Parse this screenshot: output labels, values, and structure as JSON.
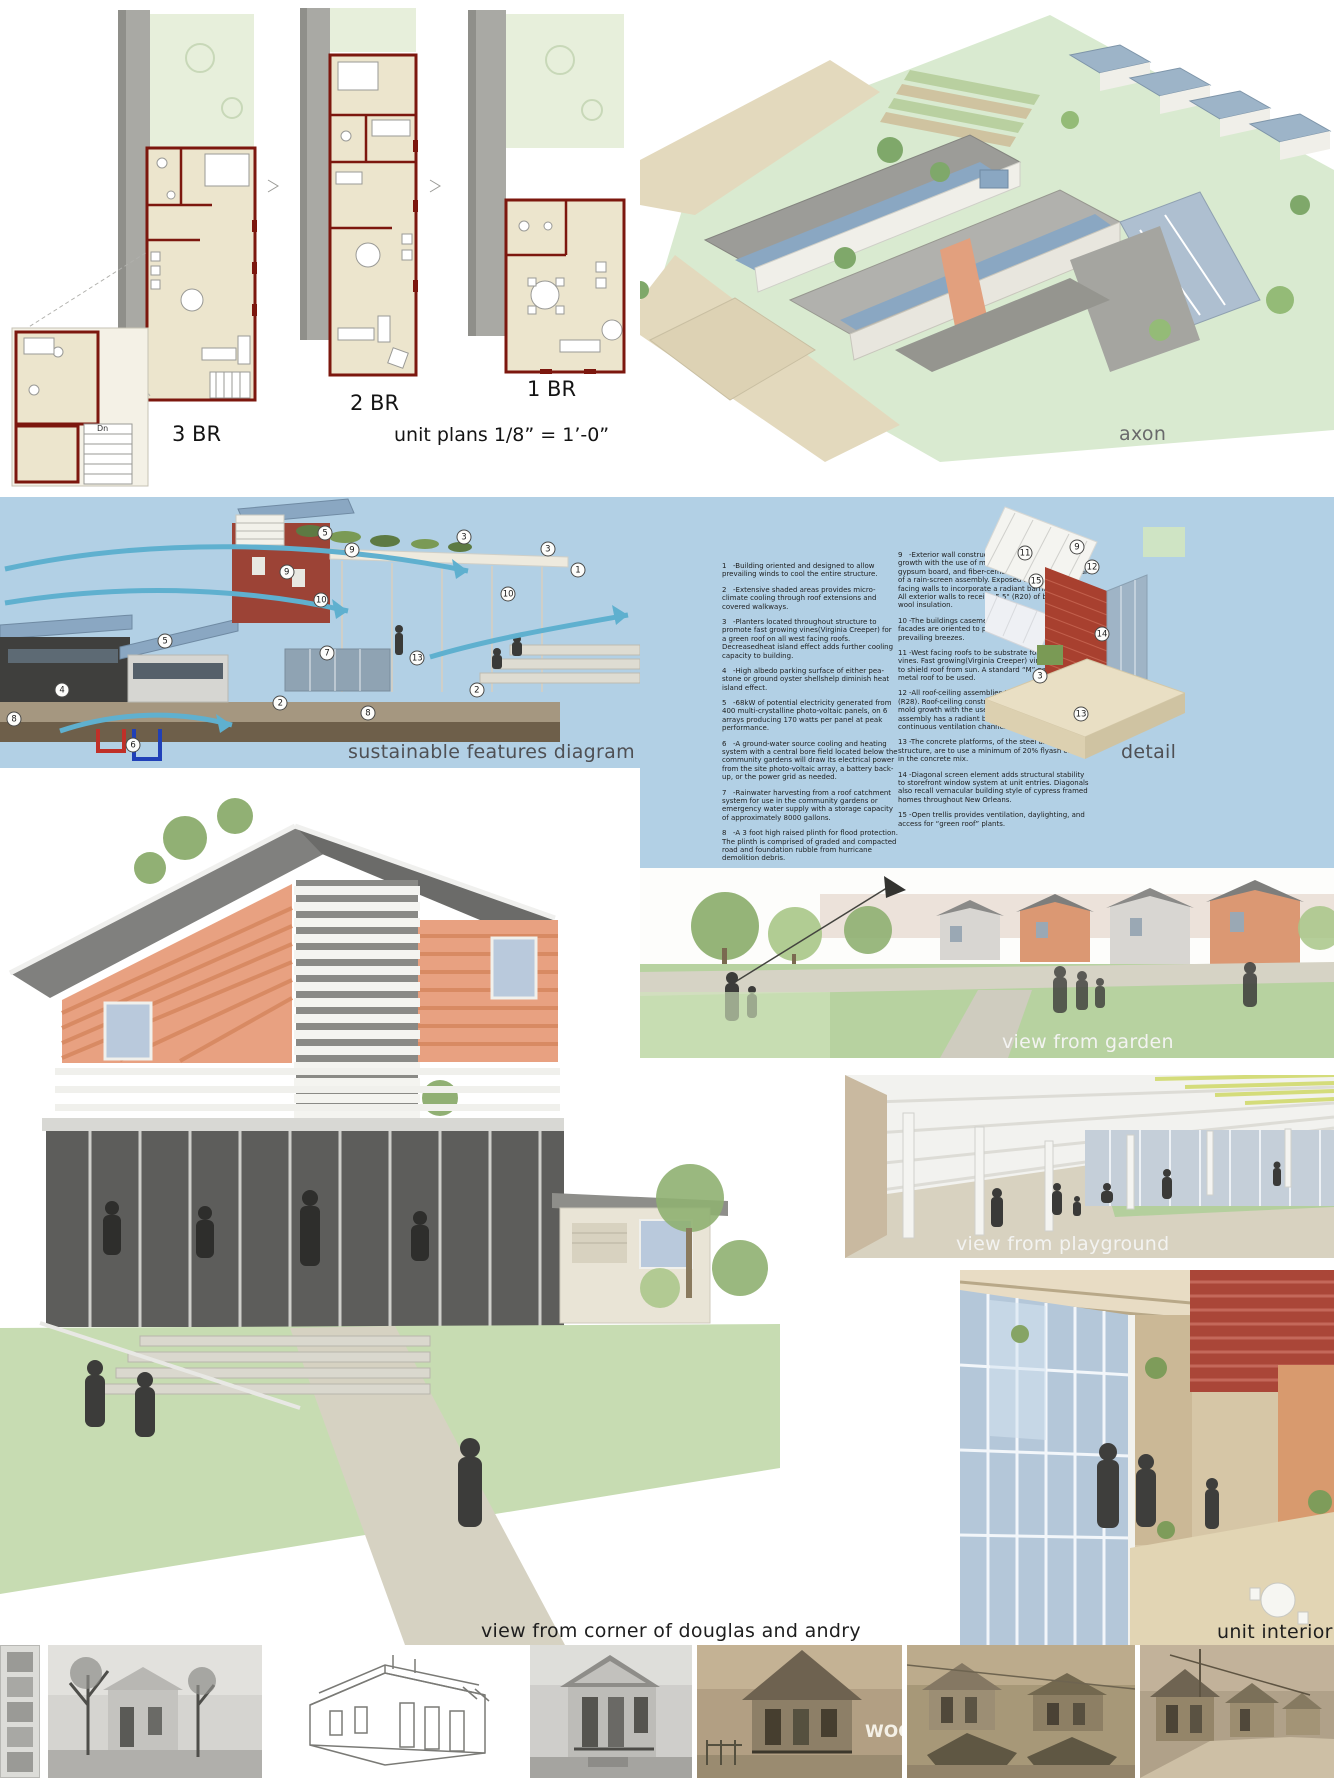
{
  "plans": {
    "label_3br": "3 BR",
    "label_2br": "2 BR",
    "label_1br": "1 BR",
    "scale_note": "unit plans 1/8” = 1’-0”",
    "stair_label": "Dn"
  },
  "axon": {
    "caption": "axon"
  },
  "features": {
    "caption": "sustainable features diagram",
    "detail_caption": "detail",
    "items_left": [
      {
        "n": "1",
        "t": "-Building oriented and designed to allow prevailing winds to cool the entire structure."
      },
      {
        "n": "2",
        "t": "-Extensive shaded areas provides micro-climate cooling through roof extensions and covered walkways."
      },
      {
        "n": "3",
        "t": "-Planters located throughout structure to promote fast growing vines(Virginia Creeper) for a green roof on all west facing roofs. Decreasedheat island effect adds further cooling capacity to building."
      },
      {
        "n": "4",
        "t": "-High albedo parking surface of either pea-stone or ground oyster shellshelp diminish heat island effect."
      },
      {
        "n": "5",
        "t": "-68kW of potential electricity generated from 400 multi-crystalline photo-voltaic panels, on 6 arrays producing 170 watts per panel at peak performance."
      },
      {
        "n": "6",
        "t": "-A ground-water source cooling and heating system with a central bore field located below the community gardens will draw its electrical power from the site photo-voltaic array, a battery back-up, or the power grid as needed."
      },
      {
        "n": "7",
        "t": "-Rainwater harvesting from a roof catchment system for use in the community gardens or emergency water supply with a storage capacity of approximately 8000 gallons."
      },
      {
        "n": "8",
        "t": "-A 3 foot high raised plinth for flood protection. The plinth is comprised of graded and compacted road and foundation rubble from hurricane demolition debris."
      }
    ],
    "items_right": [
      {
        "n": "9",
        "t": "-Exterior wall construction designed to inhibit mold growth with the use of metal studs, fiberglass backed gypsum board, and fiber-cement siding applied as part of a rain-screen assembly. Exposed south and west facing walls to incorporate a radiant barrier assembly. All exterior walls to receive 5.5\" (R20) of blown in rock wool insulation."
      },
      {
        "n": "10",
        "t": "-The buildings casement windows, on east and west facades are oriented to pen to the river and the prevailing breezes."
      },
      {
        "n": "11",
        "t": "-West facing roofs to be substrate for “green roof” vines. Fast growing(Virginia Creeper) vines cultivated to shield roof from sun. A standard “M” panel type metal roof to be used."
      },
      {
        "n": "12",
        "t": "-All roof-ceiling assemblies to receive 8-inches (R28). Roof-ceiling construction designed to inhibit mold growth with the use of metal rafters. Roof assembly has a radiant barrier under a 1/2-inch continuous ventilation channel at each rafter bay."
      },
      {
        "n": "13",
        "t": "-The concrete platforms, of the steel and concrete structure, are to use a minimum of 20% flyash content in the concrete mix."
      },
      {
        "n": "14",
        "t": "-Diagonal screen element adds structural stability to storefront window system at unit entries. Diagonals also recall vernacular building style of cypress framed homes throughout New Orleans."
      },
      {
        "n": "15",
        "t": "-Open trellis provides ventilation, daylighting, and access for “green roof” plants."
      }
    ],
    "diagram_callouts": [
      {
        "n": "5",
        "x": "50.8%",
        "y": "13.3%"
      },
      {
        "n": "9",
        "x": "55.0%",
        "y": "19.6%"
      },
      {
        "n": "3",
        "x": "72.5%",
        "y": "14.8%"
      },
      {
        "n": "3",
        "x": "85.6%",
        "y": "19.2%"
      },
      {
        "n": "1",
        "x": "90.3%",
        "y": "26.9%"
      },
      {
        "n": "9",
        "x": "44.8%",
        "y": "27.7%"
      },
      {
        "n": "10",
        "x": "50.2%",
        "y": "38.0%"
      },
      {
        "n": "10",
        "x": "79.4%",
        "y": "35.8%"
      },
      {
        "n": "5",
        "x": "25.8%",
        "y": "53.1%"
      },
      {
        "n": "7",
        "x": "51.1%",
        "y": "57.6%"
      },
      {
        "n": "13",
        "x": "65.2%",
        "y": "59.4%"
      },
      {
        "n": "4",
        "x": "9.7%",
        "y": "71.2%"
      },
      {
        "n": "2",
        "x": "43.8%",
        "y": "76.0%"
      },
      {
        "n": "2",
        "x": "74.5%",
        "y": "71.2%"
      },
      {
        "n": "8",
        "x": "57.5%",
        "y": "79.7%"
      },
      {
        "n": "8",
        "x": "2.2%",
        "y": "81.9%"
      },
      {
        "n": "6",
        "x": "20.8%",
        "y": "91.5%"
      }
    ],
    "detail_callouts": [
      {
        "n": "11",
        "x": "20.0%",
        "y": "20.7%"
      },
      {
        "n": "9",
        "x": "46.0%",
        "y": "18.5%"
      },
      {
        "n": "12",
        "x": "53.5%",
        "y": "25.8%"
      },
      {
        "n": "15",
        "x": "25.5%",
        "y": "31.0%"
      },
      {
        "n": "14",
        "x": "58.5%",
        "y": "50.6%"
      },
      {
        "n": "3",
        "x": "27.5%",
        "y": "66.1%"
      },
      {
        "n": "13",
        "x": "48.0%",
        "y": "80.1%"
      }
    ]
  },
  "views": {
    "garden_caption": "view from garden",
    "playground_caption": "view from playground",
    "corner_caption": "view from corner of douglas and andry",
    "interior_caption": "unit interior"
  },
  "photos": {
    "sign_text": "WOO"
  },
  "colors": {
    "band_blue": "#b2d0e5",
    "plan_wall_maroon": "#7c170e",
    "plan_room_cream": "#ece5cd",
    "roof_gray": "#a9a9a4",
    "site_green": "#d9ead0",
    "lawn_green": "#b7d2a0",
    "pv_blue": "#8aa7c2",
    "siding_orange": "#e8a181",
    "arrow_cyan": "#5fb0cf",
    "sepia_photo": "#b29f83"
  }
}
